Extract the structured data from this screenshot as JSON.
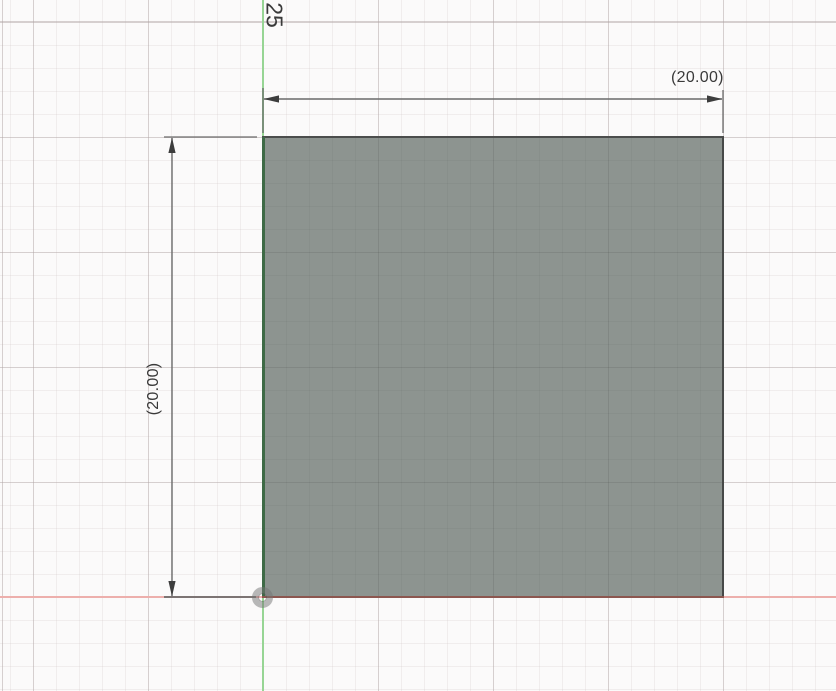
{
  "canvas": {
    "dimension_labels": {
      "horizontal": "(20.00)",
      "vertical": "(20.00)",
      "partial_top": "25"
    },
    "colors": {
      "background": "#fbfafa",
      "grid_minor": "#f1eeee",
      "grid_major": "#e3e0e0",
      "axis_x_red": "#edafac",
      "axis_y_green": "#97d594",
      "profile_fill": "#8d9490",
      "sketch_edge_dark": "#4b4d4c",
      "sketch_edge_green": "#3e6a46",
      "sketch_edge_red": "#8c564f",
      "dimension_line": "#6b6b6b",
      "dimension_arrow": "#3d3d3d",
      "dimension_text": "#3a3a3a",
      "origin_halo": "rgba(115,115,115,0.5)"
    }
  }
}
